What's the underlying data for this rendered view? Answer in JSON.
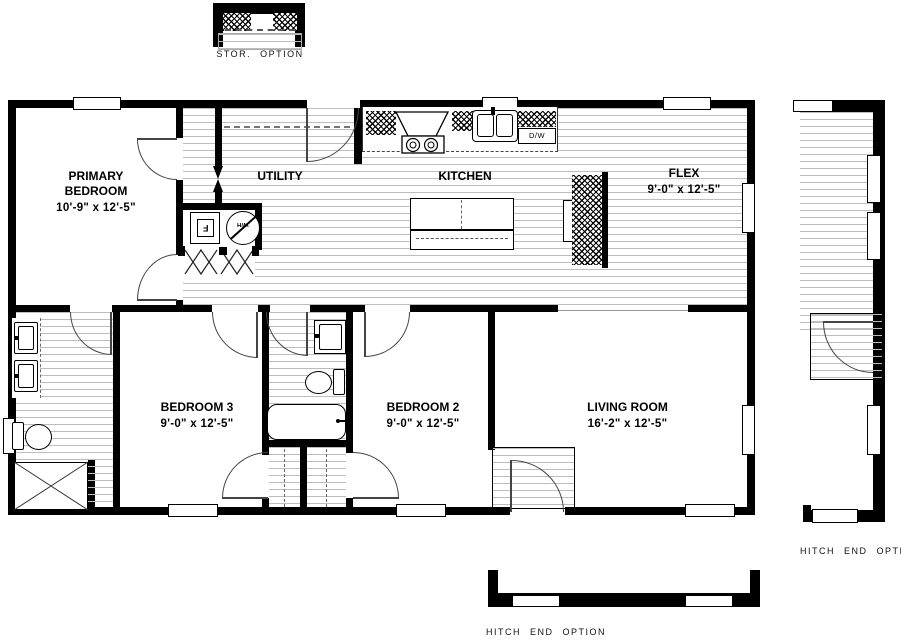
{
  "rooms": {
    "primary_bedroom": {
      "line1": "PRIMARY",
      "line2": "BEDROOM",
      "dims": "10'-9\" x  12'-5\""
    },
    "utility": {
      "name": "UTILITY"
    },
    "kitchen": {
      "name": "KITCHEN"
    },
    "flex": {
      "name": "FLEX",
      "dims": "9'-0\" x  12'-5\""
    },
    "bedroom3": {
      "name": "BEDROOM 3",
      "dims": "9'-0\" x  12'-5\""
    },
    "bedroom2": {
      "name": "BEDROOM 2",
      "dims": "9'-0\" x  12'-5\""
    },
    "living_room": {
      "name": "LIVING ROOM",
      "dims": "16'-2\" x  12'-5\""
    }
  },
  "options": {
    "storage": "STOR. OPTION",
    "hitch_right": "HITCH END OPTION",
    "hitch_bottom": "HITCH END OPTION"
  },
  "appliances": {
    "dishwasher": "D/W",
    "furnace": "F",
    "water_heater": "W/H"
  },
  "colors": {
    "wall": "#000000",
    "floor_hatch_line": "#bdbdbd",
    "background": "#ffffff",
    "door_arc": "#444444"
  }
}
